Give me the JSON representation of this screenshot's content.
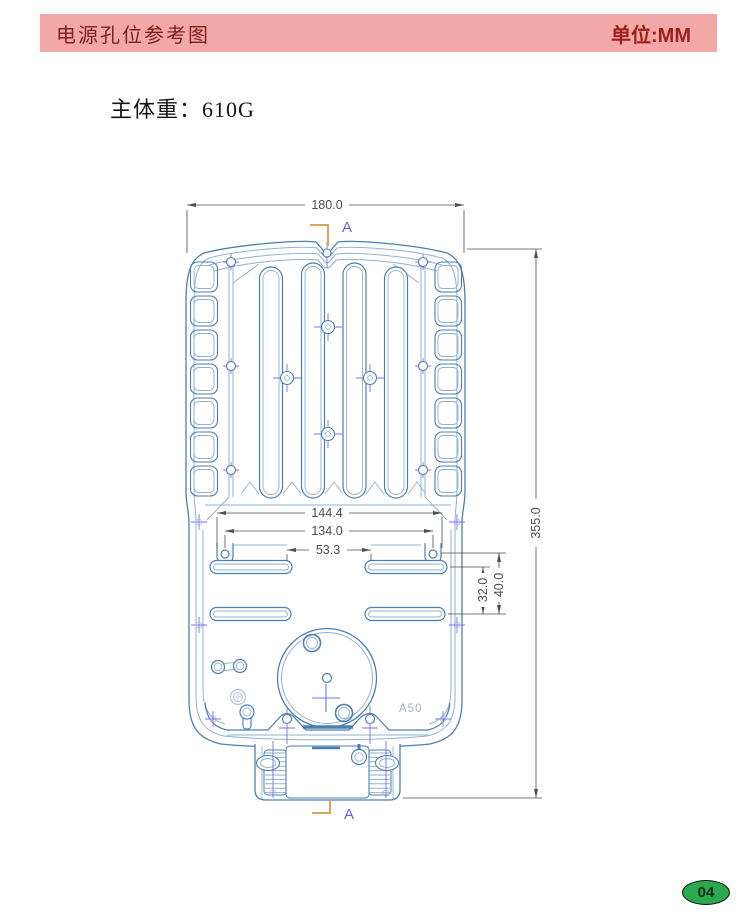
{
  "header": {
    "title": "电源孔位参考图",
    "unit": "单位:MM"
  },
  "weight": {
    "text": "主体重：610G"
  },
  "drawing": {
    "section_marker": "A",
    "model_label": "A50",
    "dimensions": {
      "overall_width": "180.0",
      "overall_height": "355.0",
      "mount_width_outer": "144.4",
      "mount_width_inner": "134.0",
      "slot_inner_gap": "53.3",
      "row_spacing": "32.0",
      "row_to_hole": "40.0"
    },
    "colors": {
      "line": "#4d7fae",
      "line_light": "#8fb2d2",
      "centerline": "#7373e8",
      "dimension": "#4d4d4d",
      "marker": "#dfa35e",
      "label": "#6a5fe0"
    }
  },
  "footer": {
    "page_number": "04"
  }
}
